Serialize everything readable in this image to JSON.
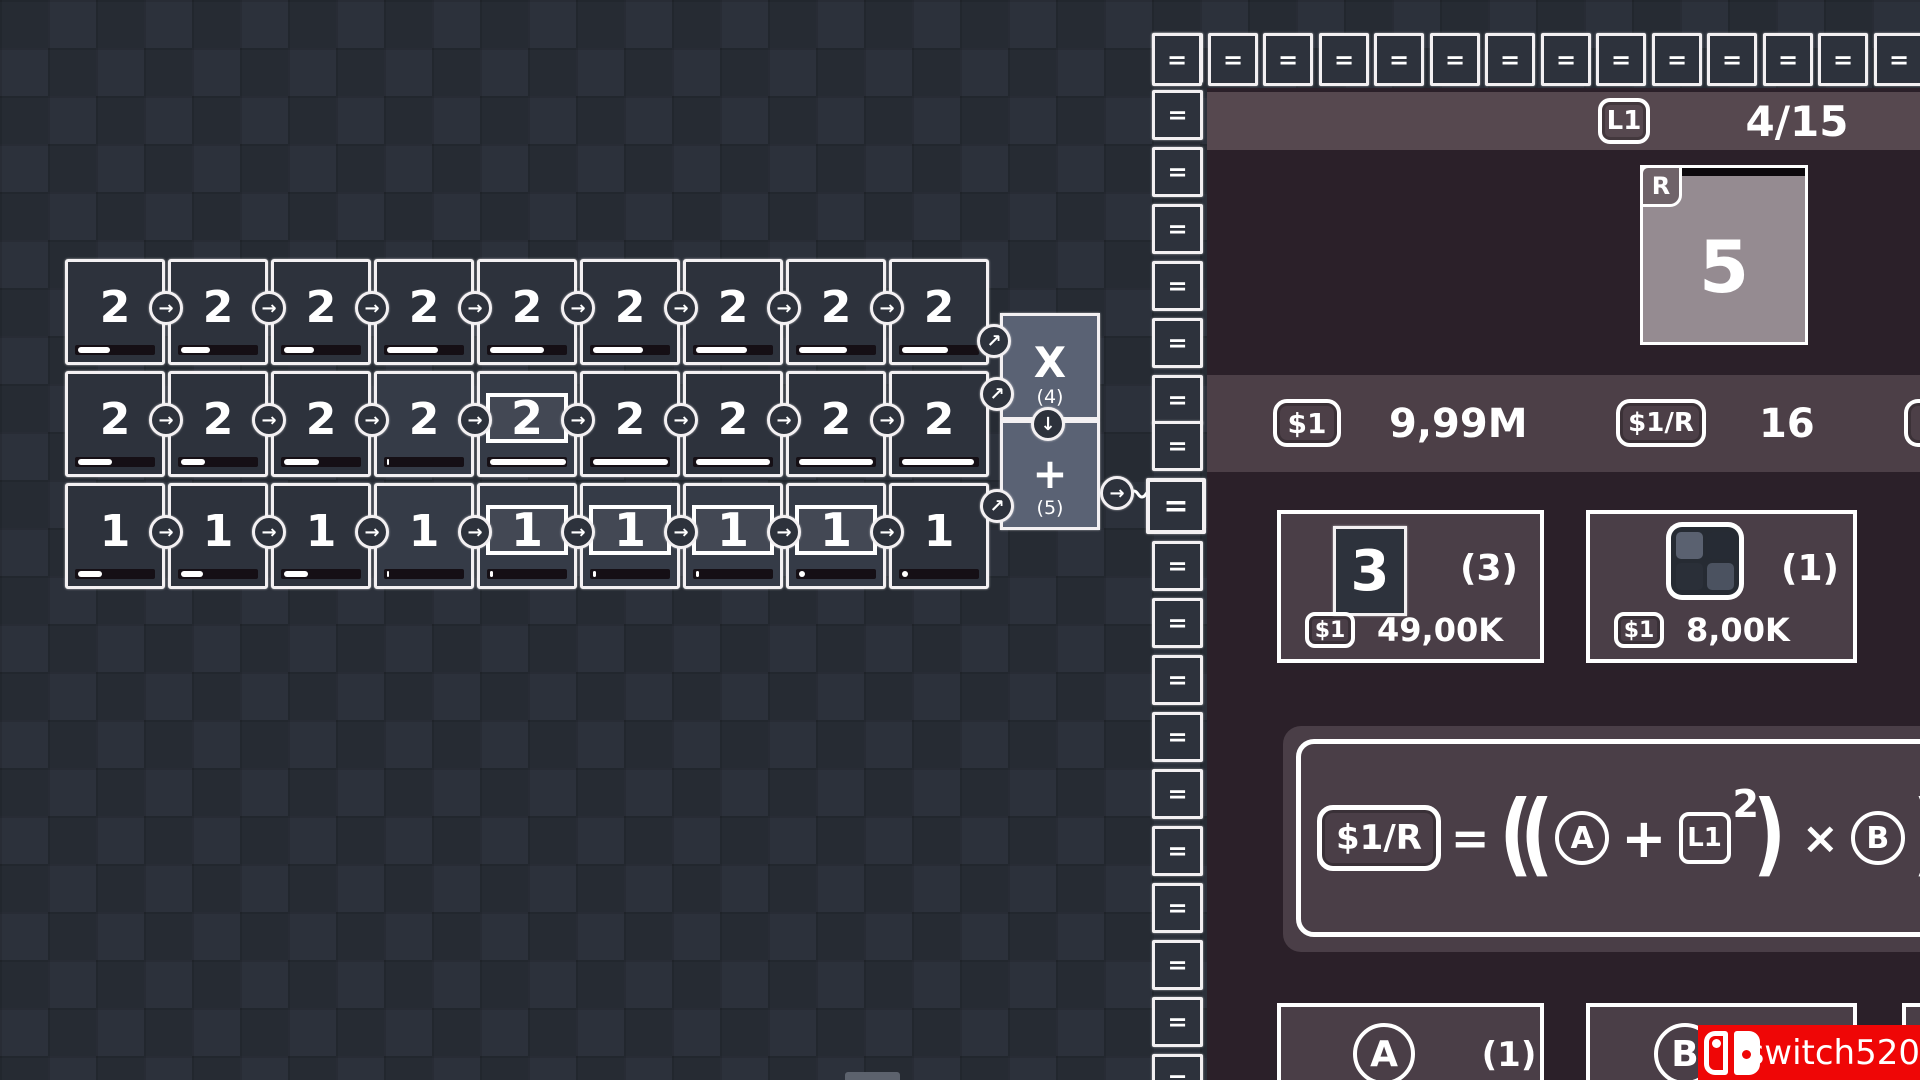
{
  "symbols": {
    "equals": "=",
    "right_arrow": "→",
    "diag_arrow": "↗",
    "down_arrow": "↓"
  },
  "colors": {
    "watermark_red": "#ef0606",
    "panel_dark": "#2b2029",
    "panel_light": "#4c3f47",
    "cell_bg": "#2d323c"
  },
  "grid": {
    "rows": [
      {
        "cells": [
          {
            "value": "2",
            "progress": 40
          },
          {
            "value": "2",
            "progress": 36
          },
          {
            "value": "2",
            "progress": 38
          },
          {
            "value": "2",
            "progress": 64
          },
          {
            "value": "2",
            "progress": 68
          },
          {
            "value": "2",
            "progress": 62
          },
          {
            "value": "2",
            "progress": 64
          },
          {
            "value": "2",
            "progress": 60
          },
          {
            "value": "2",
            "progress": 58
          }
        ]
      },
      {
        "cells": [
          {
            "value": "2",
            "progress": 42
          },
          {
            "value": "2",
            "progress": 30
          },
          {
            "value": "2",
            "progress": 44
          },
          {
            "value": "2",
            "progress": 3,
            "light": true
          },
          {
            "value": "2",
            "progress": 95,
            "selected": true,
            "light": true
          },
          {
            "value": "2",
            "progress": 94
          },
          {
            "value": "2",
            "progress": 93
          },
          {
            "value": "2",
            "progress": 92
          },
          {
            "value": "2",
            "progress": 90
          }
        ]
      },
      {
        "cells": [
          {
            "value": "1",
            "progress": 30
          },
          {
            "value": "1",
            "progress": 28
          },
          {
            "value": "1",
            "progress": 30
          },
          {
            "value": "1",
            "progress": 3,
            "light": true
          },
          {
            "value": "1",
            "progress": 4,
            "selected": true,
            "light": true
          },
          {
            "value": "1",
            "progress": 4,
            "selected": true,
            "light": true
          },
          {
            "value": "1",
            "progress": 4,
            "selected": true,
            "light": true
          },
          {
            "value": "1",
            "progress": 8,
            "selected": true,
            "light": true
          },
          {
            "value": "1",
            "progress": 8
          }
        ]
      }
    ]
  },
  "operators": {
    "multiply": {
      "symbol": "X",
      "count": "(4)"
    },
    "add": {
      "symbol": "+",
      "count": "(5)"
    }
  },
  "panel": {
    "header": {
      "badge": "L1",
      "counter": "4/15"
    },
    "reward_card": {
      "badge": "R",
      "value": "5"
    },
    "currency": {
      "money": {
        "badge": "$1",
        "value": "9,99M"
      },
      "rate": {
        "badge": "$1/R",
        "value": "16"
      }
    },
    "shop_cards": [
      {
        "tile": "3",
        "count": "(3)",
        "price_badge": "$1",
        "price": "49,00K"
      },
      {
        "icon": "grid-2x2",
        "count": "(1)",
        "price_badge": "$1",
        "price": "8,00K"
      }
    ],
    "formula": {
      "result": "$1/R",
      "eq": "=",
      "open": "((",
      "var_a": "A",
      "plus": "+",
      "level": "L1",
      "exp": "2",
      "close1": ")",
      "times": "×",
      "var_b": "B",
      "close2": ")"
    },
    "bottom_cards": [
      {
        "label": "A",
        "count": "(1)"
      },
      {
        "label": "B",
        "count": ""
      }
    ]
  },
  "watermark": {
    "text": "switch520"
  }
}
